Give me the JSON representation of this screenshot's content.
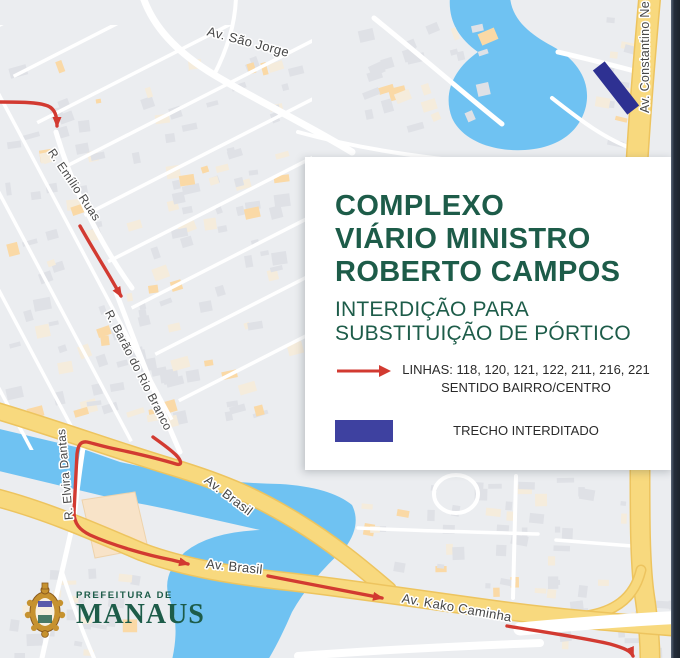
{
  "card": {
    "title_lines": [
      "COMPLEXO",
      "VIÁRIO MINISTRO",
      "ROBERTO CAMPOS"
    ],
    "subtitle_lines": [
      "INTERDIÇÃO PARA",
      "SUBSTITUIÇÃO DE PÓRTICO"
    ],
    "legend": [
      {
        "symbol": "route-arrow",
        "lines": [
          "LINHAS: 118, 120, 121, 122, 211, 216, 221",
          "SENTIDO BAIRRO/CENTRO"
        ]
      },
      {
        "symbol": "closed-swatch",
        "lines": [
          "TRECHO INTERDITADO"
        ]
      }
    ]
  },
  "logo": {
    "top": "PREFEITURA DE",
    "name": "MANAUS"
  },
  "colors": {
    "accent_green": "#1D5C49",
    "route_red": "#D23A31",
    "closed_navy": "#2E3192",
    "legend_navy": "#3E41A0",
    "water": "#6FC2F2",
    "map_bg": "#EBEDF0",
    "road_white": "#FFFFFF",
    "road_yellow": "#F8D97E",
    "road_yellow_edge": "#EDC45F",
    "building_gray": "#DFE1E6",
    "building_cream": "#F5ECDC",
    "building_orange": "#FAD9A6",
    "big_building_peach": "#F8E3C8",
    "label_gray": "#474747",
    "border_dark": "#242D3A"
  },
  "map": {
    "street_labels": [
      {
        "text": "Av. São Jorge",
        "x": 247,
        "y": 46,
        "rot": 15,
        "size": 13
      },
      {
        "text": "R. Emílio Ruas",
        "x": 71,
        "y": 187,
        "rot": 56,
        "size": 12
      },
      {
        "text": "R. Barão do Rio Branco",
        "x": 135,
        "y": 372,
        "rot": 63,
        "size": 12
      },
      {
        "text": "R. Elvira Dantas",
        "x": 69,
        "y": 474,
        "rot": -95,
        "size": 12
      },
      {
        "text": "Av. Brasil",
        "x": 226,
        "y": 499,
        "rot": 37,
        "size": 13
      },
      {
        "text": "Av. Brasil",
        "x": 234,
        "y": 571,
        "rot": 6,
        "size": 13
      },
      {
        "text": "Av. Kako Caminha",
        "x": 456,
        "y": 612,
        "rot": 10,
        "size": 13
      },
      {
        "text": "Av. Constantino Ne",
        "x": 649,
        "y": 57,
        "rot": -90,
        "size": 12.5
      }
    ],
    "water": [
      "M 450,-3 C 448,20 458,38 478,52 C 455,68 442,92 452,118 C 462,140 492,152 525,150 C 558,148 580,132 586,106 C 591,82 578,60 552,46 C 530,34 512,20 510,-3 Z",
      "M -5,428 L 80,448 Q 100,455 120,462 L 180,475 Q 230,483 280,484 Q 330,487 352,505 Q 362,525 345,548 L 330,560 Q 300,540 260,530 L 180,512 Q 150,505 120,500 L -5,470 Z",
      "M 345,548 Q 310,580 292,612 Q 280,640 268,660 L 172,660 Q 180,625 170,600 Q 160,575 185,552 Q 210,532 260,530 Q 310,532 345,548 Z"
    ],
    "big_building": "M 82,500 L 135,492 L 148,548 L 95,558 Z",
    "building_regions": [
      {
        "x": 5,
        "y": 58,
        "w": 290,
        "h": 175,
        "count": 75,
        "angle": -14
      },
      {
        "x": 5,
        "y": 238,
        "w": 285,
        "h": 185,
        "count": 75,
        "angle": -14
      },
      {
        "x": 355,
        "y": 15,
        "w": 125,
        "h": 135,
        "count": 26,
        "angle": -18
      },
      {
        "x": 585,
        "y": 15,
        "w": 48,
        "h": 135,
        "count": 12,
        "angle": 10
      },
      {
        "x": 358,
        "y": 478,
        "w": 265,
        "h": 112,
        "count": 48,
        "angle": 4
      },
      {
        "x": 5,
        "y": 558,
        "w": 130,
        "h": 95,
        "count": 26,
        "angle": 3
      },
      {
        "x": 555,
        "y": 598,
        "w": 115,
        "h": 55,
        "count": 12,
        "angle": 0
      }
    ],
    "street_grids": [
      {
        "origin": [
          -30,
          40
        ],
        "angle": 62,
        "step": 46,
        "count": 9,
        "len": 430,
        "width": 3.5
      },
      {
        "origin": [
          -10,
          30
        ],
        "angle": -27,
        "step": 52,
        "count": 9,
        "len": 340,
        "width": 3.5
      }
    ],
    "grid_clip": {
      "x": 0,
      "y": 25,
      "w": 312,
      "h": 425
    },
    "roads": [
      {
        "d": "M 142,-6 C 152,26 176,52 216,76 C 262,103 306,124 352,152",
        "w": 7
      },
      {
        "d": "M 214,75 C 228,48 236,22 236,-6",
        "w": 4
      },
      {
        "d": "M 374,18 C 420,55 462,92 502,124",
        "w": 5
      },
      {
        "d": "M 298,132 C 356,148 412,156 468,162",
        "w": 4
      },
      {
        "d": "M 558,52 C 592,60 616,66 638,72",
        "w": 5
      },
      {
        "d": "M 552,98 C 580,120 606,140 636,150",
        "w": 4
      },
      {
        "d": "M 56,132 C 70,180 96,238 132,288",
        "w": 5
      },
      {
        "d": "M 116,292 C 134,340 156,398 180,452",
        "w": 5
      },
      {
        "d": "M 85,436 C 80,465 77,490 74,518",
        "w": 5
      },
      {
        "d": "M 74,518 C 64,565 52,612 42,658",
        "w": 5
      },
      {
        "d": "M 62,572 C 74,610 84,635 94,658",
        "w": 4
      },
      {
        "d": "M 516,476 C 515,518 514,560 513,598",
        "w": 4
      },
      {
        "d": "M 434,494 a 22,19 0 1 0 44,0 a 22,19 0 1 0 -44,0",
        "w": 4
      },
      {
        "d": "M 358,528 C 420,531 478,532 538,534",
        "w": 3.5
      },
      {
        "d": "M 556,540 C 582,542 608,544 632,546",
        "w": 3.5
      },
      {
        "d": "M 650,-6 C 645,50 640,110 637,162",
        "w": 20,
        "y": 1
      },
      {
        "d": "M 640,468 C 640,520 640,560 644,592 C 648,618 650,638 650,660",
        "w": 18,
        "y": 1
      },
      {
        "d": "M 641,570 C 634,600 612,612 586,616",
        "w": 8,
        "y": 1
      },
      {
        "d": "M -6,410 C 55,428 115,450 172,467 C 228,484 258,498 296,521 C 332,543 360,566 388,590",
        "w": 15,
        "y": 1
      },
      {
        "d": "M -6,497 C 45,510 95,532 142,552 C 185,568 235,576 292,582 C 360,590 440,602 500,610 C 560,618 610,622 684,628",
        "w": 16,
        "y": 1
      },
      {
        "d": "M 520,629 C 575,624 625,620 684,617",
        "w": 13,
        "over": 1
      },
      {
        "d": "M 298,656 C 380,650 460,646 540,643",
        "w": 8,
        "over": 1
      }
    ],
    "closed_section": {
      "cx": 616,
      "cy": 88,
      "len": 56,
      "wid": 15,
      "angle": 52
    },
    "route_segments": [
      {
        "d": "M -6,102 C 20,102 38,102 48,106 C 55,109 57,116 57,126",
        "arrow": true
      },
      {
        "d": "M 80,226 C 90,244 100,260 110,277 C 114,284 118,291 121,296",
        "arrow": true
      },
      {
        "d": "M 153,437 C 160,442 170,449 176,455 C 181,460 183,466 176,464 C 166,461 143,455 120,450 C 104,447 92,443 87,442 C 80,441 78,446 77,454 C 76,472 75,492 74,512 C 74,524 80,530 90,535 C 112,545 146,555 172,560 L 188,564",
        "arrow": true
      },
      {
        "d": "M 268,576 C 305,583 345,591 382,598",
        "arrow": true
      },
      {
        "d": "M 507,626 C 550,633 585,638 610,644 C 624,648 631,651 633,656",
        "arrow": true
      }
    ]
  }
}
